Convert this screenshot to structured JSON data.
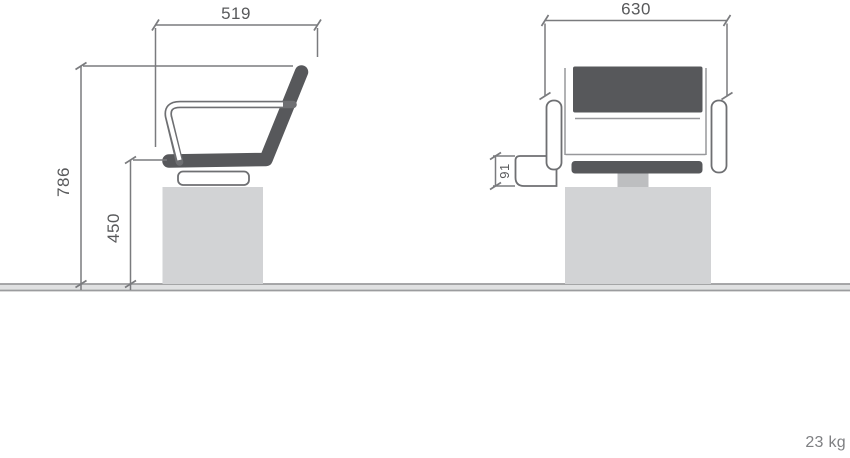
{
  "labels": {
    "side_width": "519",
    "side_height": "786",
    "side_seat_height": "450",
    "front_width": "630",
    "front_armrest_height": "91",
    "weight": "23 kg"
  },
  "drawing": {
    "type": "furniture-dimension-drawing",
    "views": [
      "side-elevation",
      "front-elevation"
    ],
    "dimensions_mm": {
      "overall_depth": "519",
      "overall_height": "786",
      "seat_height": "450",
      "overall_width": "630",
      "armrest_bracket_height": "91"
    },
    "weight": "23 kg"
  },
  "colors": {
    "shell": "#57585b",
    "outline": "#6e6f72",
    "dim": "#7a7b7e",
    "text": "#58595b",
    "base": "#d2d3d5",
    "stem": "#bdbec0",
    "thin_line": "#97989b",
    "floor_line": "#9b9c9e",
    "floor_fill": "#e0e1e2",
    "muted_text": "#7e7f82",
    "background": "#ffffff"
  }
}
